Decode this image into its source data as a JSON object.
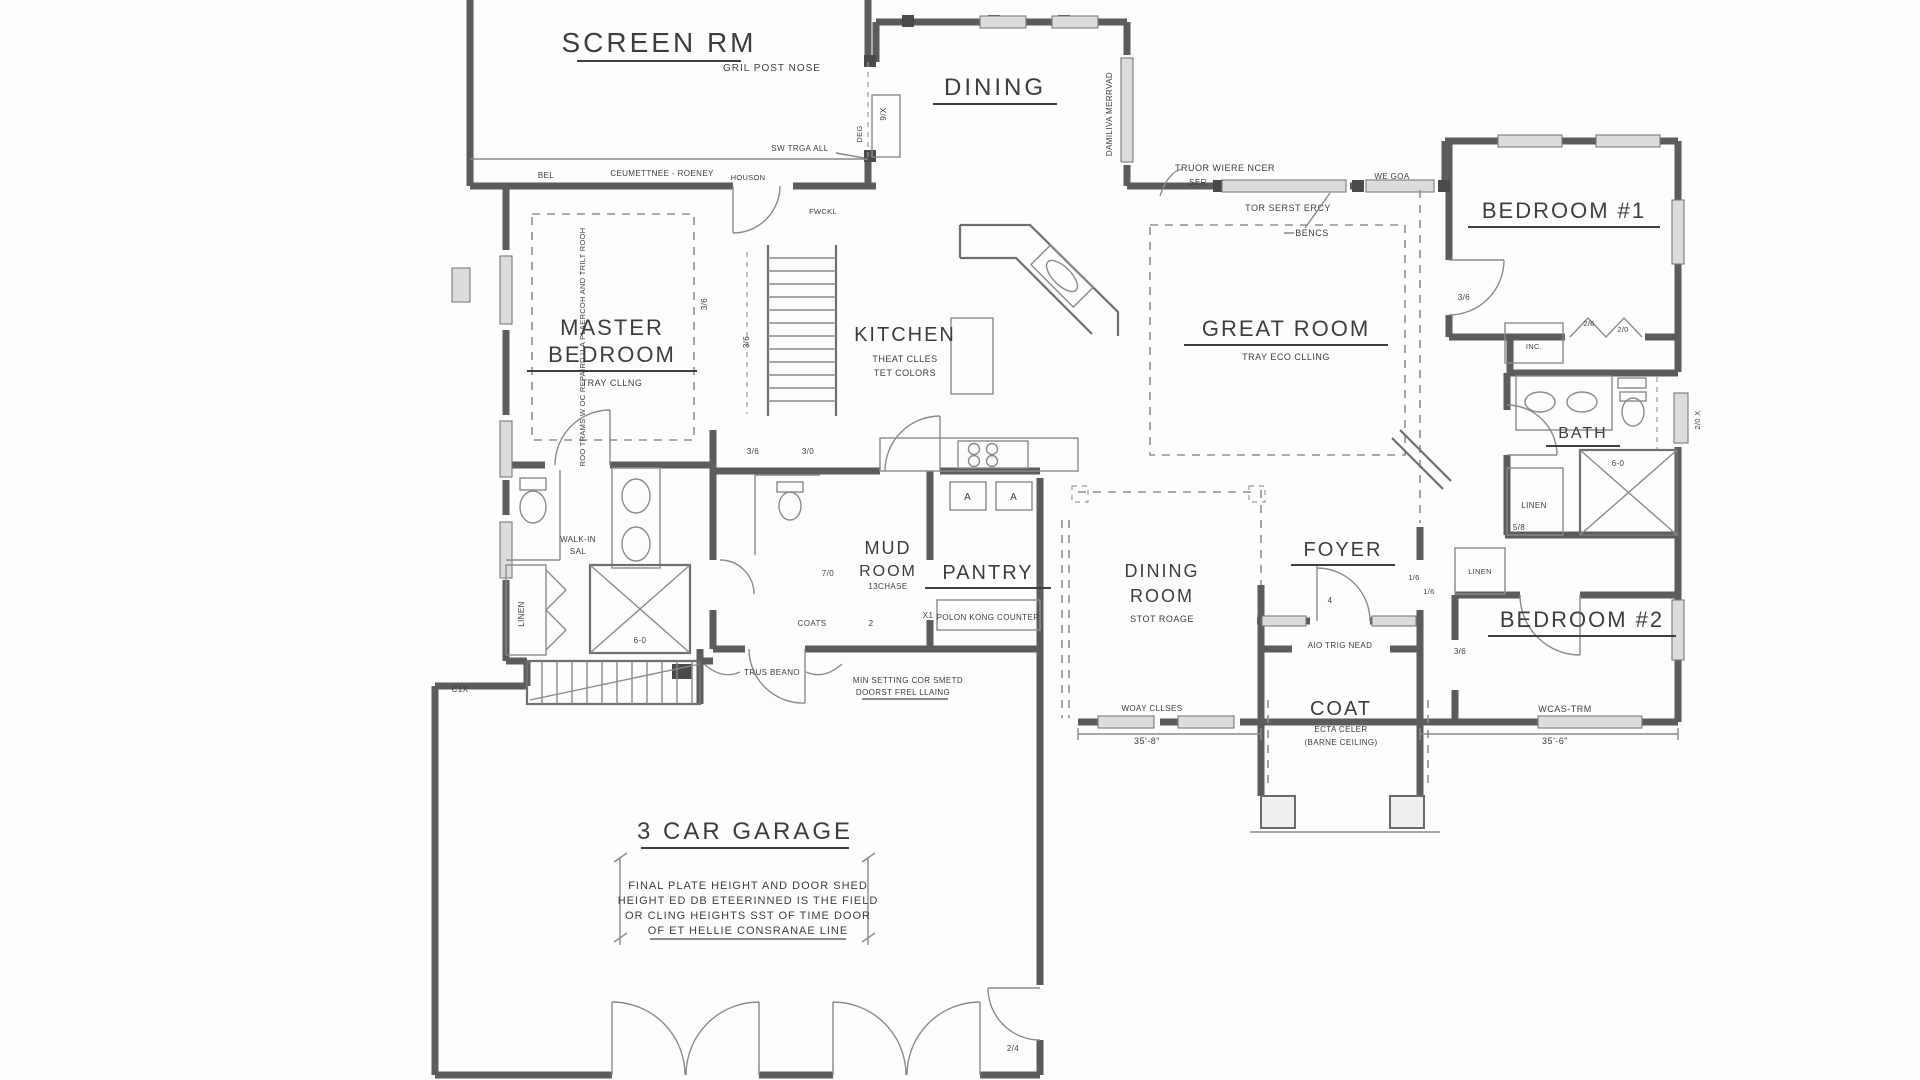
{
  "colors": {
    "background": "#fdfdfd",
    "ink": "#3d3d3d",
    "wall": "#5c5c5c"
  },
  "rooms": {
    "screen_rm": {
      "label": "SCREEN RM"
    },
    "dining": {
      "label": "DINING"
    },
    "bedroom1": {
      "label": "BEDROOM #1"
    },
    "master_bedroom": {
      "line1": "MASTER",
      "line2": "BEDROOM",
      "sub": "TRAY CLLNG"
    },
    "kitchen": {
      "label": "KITCHEN",
      "sub1": "THEAT CLLES",
      "sub2": "TET COLORS"
    },
    "great_room": {
      "label": "GREAT ROOM",
      "sub": "TRAY ECO CLLING"
    },
    "bath": {
      "label": "BATH"
    },
    "mud_room": {
      "line1": "MUD",
      "line2": "ROOM",
      "sub": "13CHASE"
    },
    "pantry": {
      "label": "PANTRY",
      "note": "POLON KONG COUNTER"
    },
    "dining_room": {
      "line1": "DINING",
      "line2": "ROOM",
      "sub": "STOT ROAGE"
    },
    "foyer": {
      "label": "FOYER",
      "note": "AIO TRIG NEAD"
    },
    "coat": {
      "label": "COAT",
      "sub1": "ECTA CELER",
      "sub2": "(BARNE CEILING)"
    },
    "bedroom2": {
      "label": "BEDROOM #2"
    },
    "garage": {
      "label": "3 CAR GARAGE",
      "note1": "FINAL PLATE HEIGHT AND DOOR SHED",
      "note2": "HEIGHT ED DB ETEERINNED IS THE FIELD",
      "note3": "OR CLING HEIGHTS SST OF TIME DOOR",
      "note4": "OF ET HELLIE CONSRANAE LINE"
    }
  },
  "annotations": {
    "grill_post": "GRIL POST NOSE",
    "sw_trim": "SW TRGA ALL",
    "bel": "BEL",
    "ceiling_trim": "CEUMETTNEE - ROENEY",
    "houson": "HOUSON",
    "fwckl": "FWCKL",
    "truor": "TRUOR WIERE NCER",
    "ser": "SER",
    "we_goa": "WE GOA",
    "tor_serst": "TOR SERST ERCY",
    "bencs": "BENCS",
    "truss_bearing": "TRUS BEANO",
    "min_setting_1": "MIN SETTING COR SMETD",
    "min_setting_2": "DOORST FREL LLAING",
    "woay": "WOAY CLLSES",
    "c1x": "C1X",
    "window_label_vert": "DAMILIVA MERRVAD",
    "master_wall_vert": "ROO TRAMS W OC REPAIRD U A PLAERCOH AND TRILT ROOH",
    "deg": "DEG",
    "nine_x": "9/X",
    "two_vert": "2/0 X"
  },
  "closets": {
    "linen": "LINEN",
    "walkin1": "WALK-IN",
    "walkin2": "SAL",
    "coats": "COATS",
    "inc": "INC."
  },
  "appliances": {
    "a": "A"
  },
  "door_sizes": {
    "d36a": "3/6",
    "d36b": "3/6",
    "d36c": "3/6",
    "d36d": "3/6",
    "d36e": "3/6",
    "d30": "3/0",
    "d70": "7/0",
    "d26": "2/6",
    "d20": "2/0",
    "d16a": "1/6",
    "d16b": "1/6",
    "d24": "2/4",
    "d2": "2",
    "dx1": "X1",
    "d4": "4",
    "d58": "5/8",
    "d60a": "6-0",
    "d60b": "6-0"
  },
  "dimensions": {
    "left": "35'-8\"",
    "right": "35'-6\"",
    "wcas": "WCAS-TRM"
  }
}
